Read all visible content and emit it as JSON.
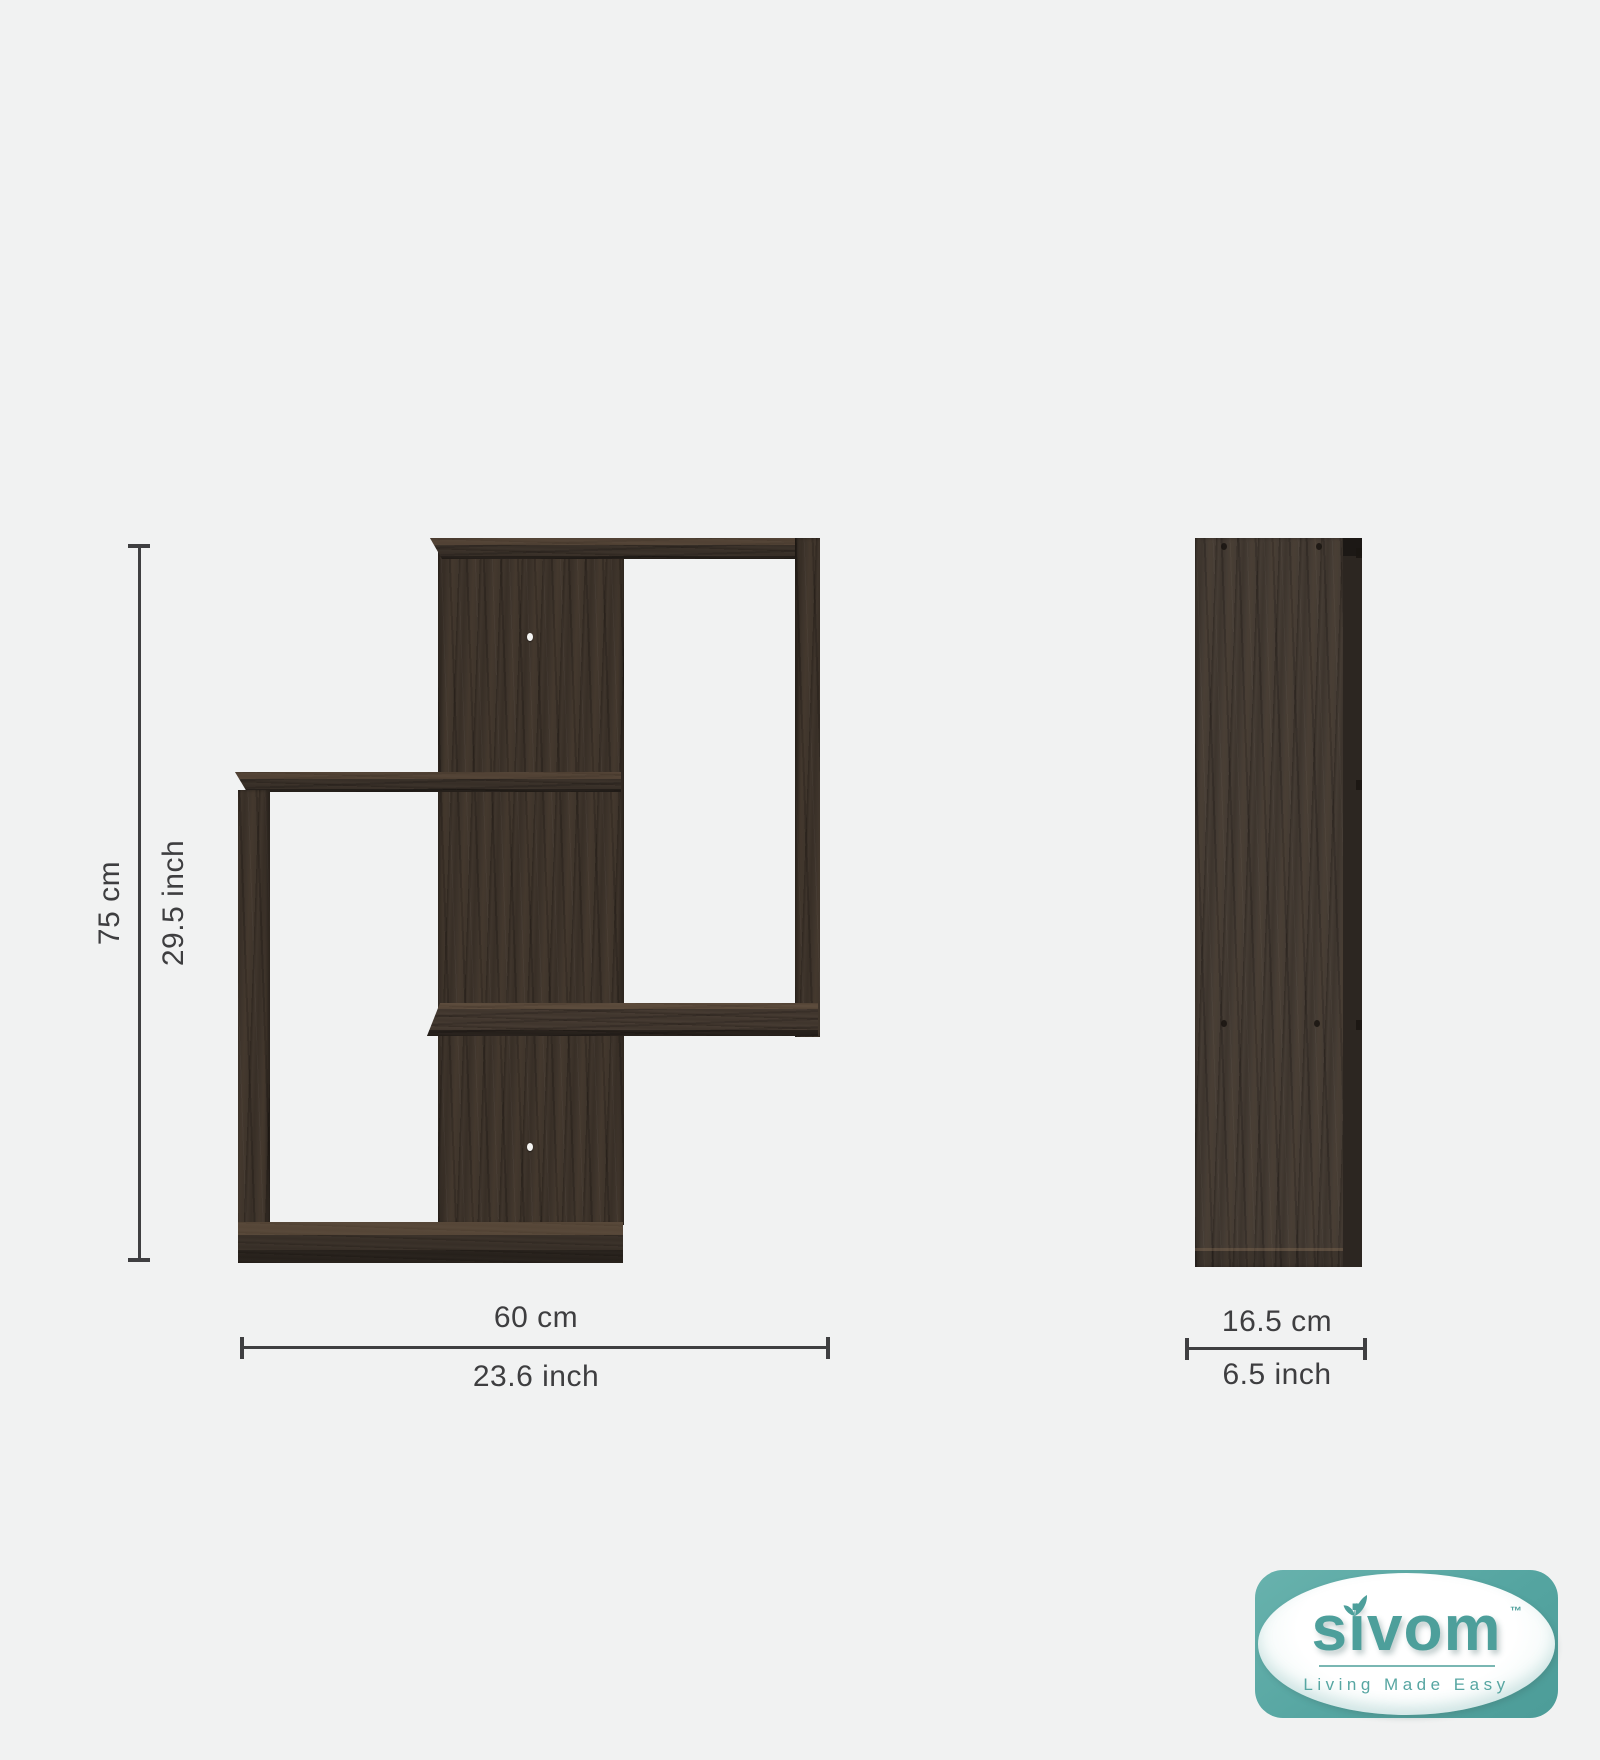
{
  "background": "#f1f2f2",
  "dimensions": {
    "height_cm": "75 cm",
    "height_inch": "29.5 inch",
    "width_cm": "60 cm",
    "width_inch": "23.6 inch",
    "depth_cm": "16.5 cm",
    "depth_inch": "6.5 inch"
  },
  "logo": {
    "brand": "sivom",
    "trademark": "™",
    "tagline": "Living Made Easy",
    "accent_color": "#4d9f9b",
    "badge_color": "#55a5a1"
  },
  "colors": {
    "dimension_lines": "#3f3f41",
    "wood_dark": "#3a312a",
    "wood_light": "#5c4e41",
    "background": "#f1f2f2"
  }
}
